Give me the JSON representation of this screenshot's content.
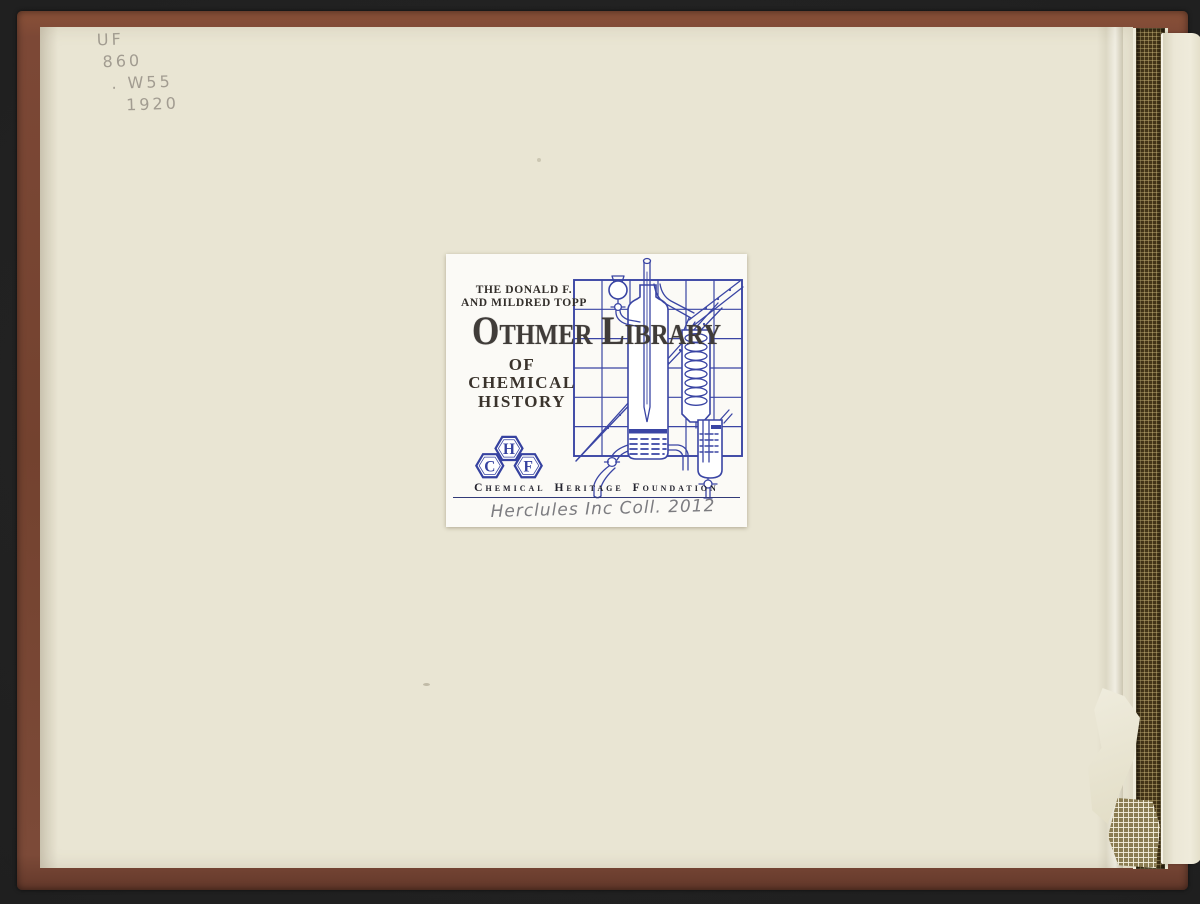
{
  "book": {
    "call_number_lines": [
      "UF",
      "860",
      ". W55",
      "1920"
    ]
  },
  "bookplate": {
    "donor_line1": "THE DONALD F.",
    "donor_line2": "AND MILDRED TOPP",
    "title": "Othmer Library",
    "subtitle_of": "OF",
    "subtitle_line1": "CHEMICAL",
    "subtitle_line2": "HISTORY",
    "logo_letters": [
      "C",
      "H",
      "F"
    ],
    "organization": "Chemical Heritage Foundation",
    "handwritten_note": "Herclules Inc Coll. 2012"
  },
  "colors": {
    "background_black": "#1f1f1f",
    "cover_brown": "#7c4836",
    "endpaper_cream": "#e9e5d3",
    "plate_white": "#fbfaf6",
    "plate_blue": "#3a45a4",
    "title_ink": "#403c39",
    "pencil_gray": "#9b958a",
    "note_gray": "#7c7c80",
    "mesh_brown": "#443518"
  }
}
